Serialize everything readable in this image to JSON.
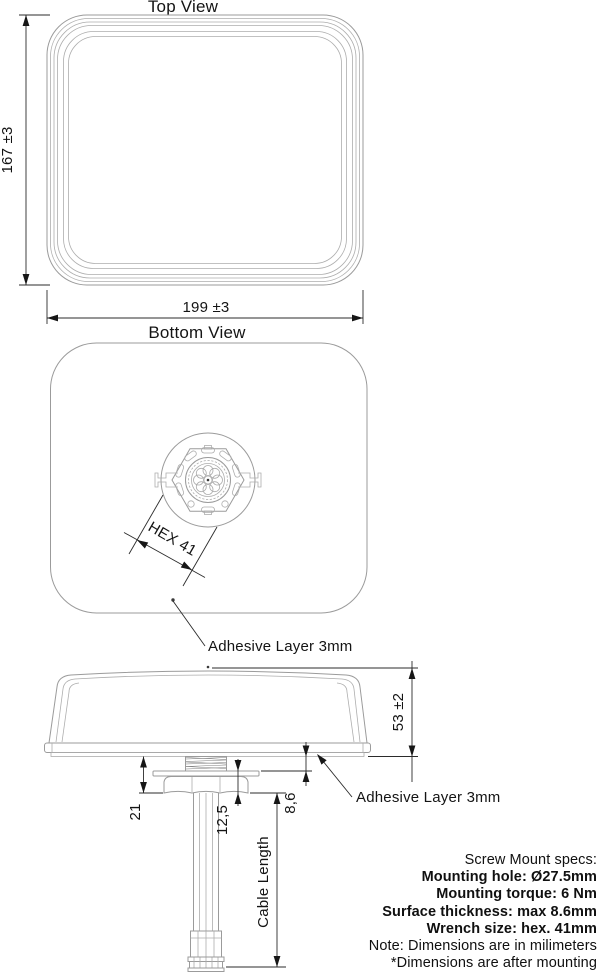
{
  "colors": {
    "outline": "#9b9b9b",
    "dimension": "#2b2b2b",
    "text": "#141414",
    "background": "#ffffff"
  },
  "top_view": {
    "title": "Top View",
    "height_dim": "167 ±3",
    "width_dim": "199 ±3"
  },
  "bottom_view": {
    "title": "Bottom View",
    "hex_dim": "HEX 41",
    "adhesive_label": "Adhesive Layer 3mm"
  },
  "side_view": {
    "height_dim": "53 ±2",
    "nut_stack_dim": "21",
    "washer_nut_dim": "12,5",
    "thread_dim": "8,6",
    "cable_dim": "Cable Length",
    "adhesive_label": "Adhesive Layer 3mm"
  },
  "specs": {
    "lines": [
      {
        "text": "Screw Mount specs:",
        "bold": false
      },
      {
        "text": "Mounting hole: Ø27.5mm",
        "bold": true
      },
      {
        "text": "Mounting torque: 6 Nm",
        "bold": true
      },
      {
        "text": "Surface thickness: max 8.6mm",
        "bold": true
      },
      {
        "text": "Wrench size: hex. 41mm",
        "bold": true
      },
      {
        "text": "Note: Dimensions are in milimeters",
        "bold": false
      },
      {
        "text": "*Dimensions are after mounting",
        "bold": false
      }
    ]
  }
}
